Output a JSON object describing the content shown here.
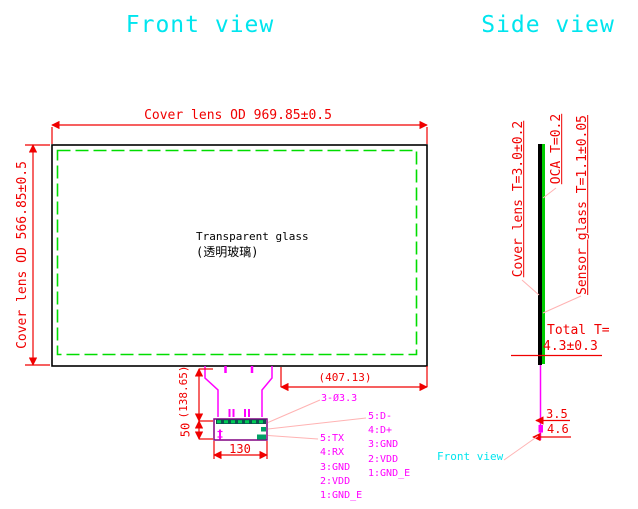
{
  "titles": {
    "front": "Front view",
    "side": "Side view"
  },
  "front": {
    "dim_width": "Cover lens OD 969.85±0.5",
    "dim_height": "Cover lens OD 566.85±0.5",
    "glass_en": "Transparent glass",
    "glass_cn": "(透明玻璃)",
    "dim_tail_len": "(138.65)",
    "dim_conn_h": "50",
    "dim_conn_w": "130",
    "dim_offset": "(407.13)",
    "holes": "3-Ø3.3",
    "uart_pins": [
      "5:TX",
      "4:RX",
      "3:GND",
      "2:VDD",
      "1:GND_E"
    ],
    "usb_pins": [
      "5:D-",
      "4:D+",
      "3:GND",
      "2:VDD",
      "1:GND_E"
    ]
  },
  "side": {
    "cover": "Cover lens T=3.0±0.2",
    "oca": "OCA T=0.2",
    "sensor": "Sensor glass T=1.1±0.05",
    "total_label": "Total T=",
    "total_value": "4.3±0.3",
    "dim_a": "3.5",
    "dim_b": "4.6",
    "pointer": "Front view"
  },
  "colors": {
    "dimension": "#f00000",
    "outline": "#000000",
    "active_area": "#00dd00",
    "tail": "#ff00ff",
    "leader": "#ffb3b3",
    "title": "#00e5ee",
    "connector": "#800080"
  }
}
